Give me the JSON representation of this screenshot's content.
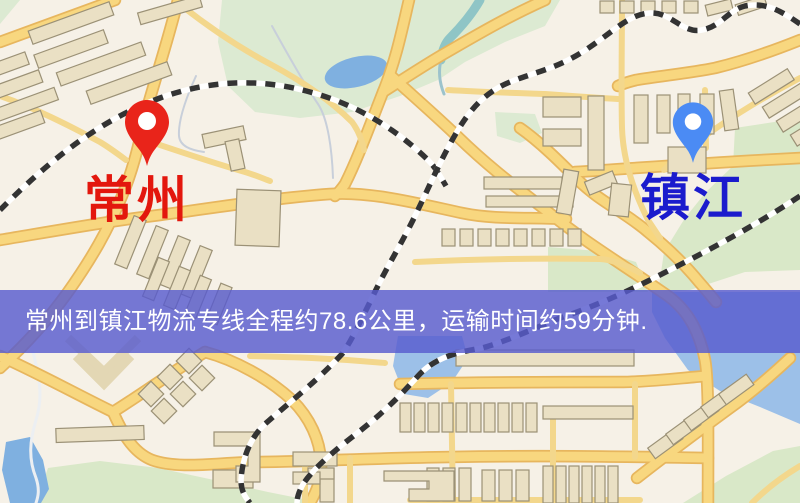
{
  "markers": {
    "origin": {
      "label": "常州",
      "icon": "red-map-pin-icon"
    },
    "destination": {
      "label": "镇江",
      "icon": "blue-map-pin-icon"
    }
  },
  "banner": {
    "text": "常州到镇江物流专线全程约78.6公里，运输时间约59分钟."
  },
  "colors": {
    "origin-pin": "#e9241a",
    "origin-label": "#e3170d",
    "dest-pin": "#4b8bf4",
    "dest-label": "#1b1bcd",
    "banner-bg": "rgba(88,92,206,0.82)",
    "banner-text": "#ffffff"
  }
}
